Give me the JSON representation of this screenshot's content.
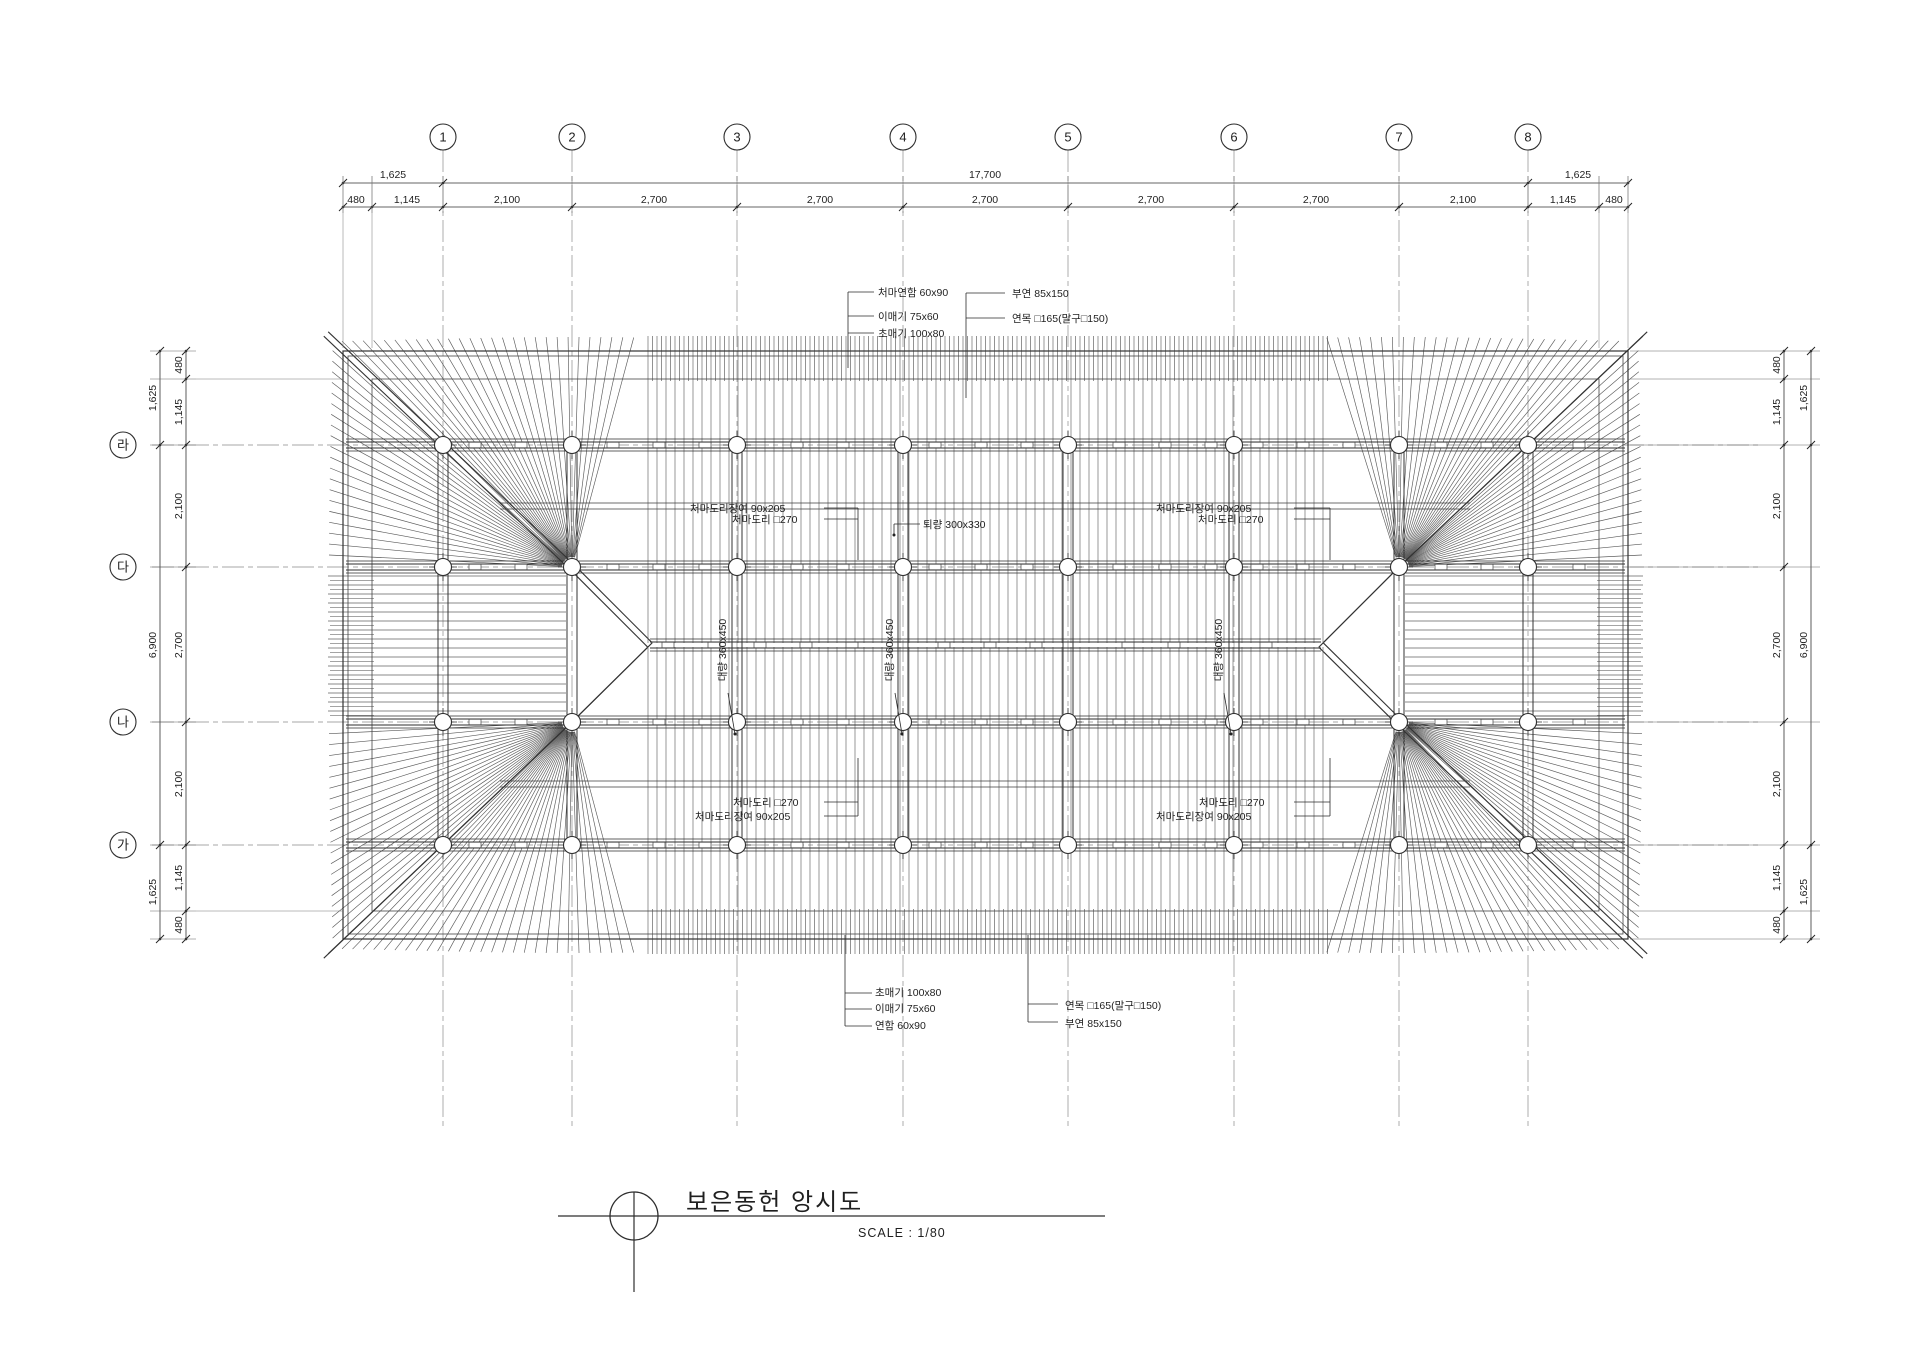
{
  "title_block": {
    "title": "보은동헌 앙시도",
    "scale_label": "SCALE : 1/80"
  },
  "grid": {
    "cols": [
      {
        "label": "1"
      },
      {
        "label": "2"
      },
      {
        "label": "3"
      },
      {
        "label": "4"
      },
      {
        "label": "5"
      },
      {
        "label": "6"
      },
      {
        "label": "7"
      },
      {
        "label": "8"
      }
    ],
    "rows": [
      {
        "label": "라"
      },
      {
        "label": "다"
      },
      {
        "label": "나"
      },
      {
        "label": "가"
      }
    ]
  },
  "dimensions": {
    "top_outer": [
      "1,625",
      "17,700",
      "1,625"
    ],
    "top_inner": [
      "480",
      "1,145",
      "2,100",
      "2,700",
      "2,700",
      "2,700",
      "2,700",
      "2,700",
      "2,100",
      "1,145",
      "480"
    ],
    "left_outer": [
      "1,625",
      "6,900",
      "1,625"
    ],
    "left_inner": [
      "480",
      "1,145",
      "2,100",
      "2,700",
      "2,100",
      "1,145",
      "480"
    ],
    "right_outer": [
      "1,625",
      "6,900",
      "1,625"
    ],
    "right_inner": [
      "480",
      "1,145",
      "2,100",
      "2,700",
      "2,100",
      "1,145",
      "480"
    ]
  },
  "annotations": {
    "top_left": [
      "처마연함 60x90",
      "이매기 75x60",
      "초매기 100x80"
    ],
    "top_right": [
      "부연 85x150",
      "연목 □165(말구□150)"
    ],
    "mid_left": [
      "처마도리장여 90x205",
      "처마도리 □270"
    ],
    "mid_right": [
      "처마도리장여 90x205",
      "처마도리 □270"
    ],
    "beam_label": "퇴량 300x330",
    "girder_labels": [
      "대량 360x450",
      "대량 360x450",
      "대량 360x450"
    ],
    "low_left": [
      "처마도리 □270",
      "처마도리장여 90x205"
    ],
    "low_right": [
      "처마도리 □270",
      "처마도리장여 90x205"
    ],
    "bottom_left": [
      "초매기 100x80",
      "이매기 75x60",
      "연함 60x90"
    ],
    "bottom_right": [
      "연목 □165(말구□150)",
      "부연 85x150"
    ]
  },
  "colors": {
    "background": "#ffffff",
    "main_line": "#2e2e2e",
    "thin_line": "#5a5a5a",
    "grid_line": "#8a8a8a"
  }
}
